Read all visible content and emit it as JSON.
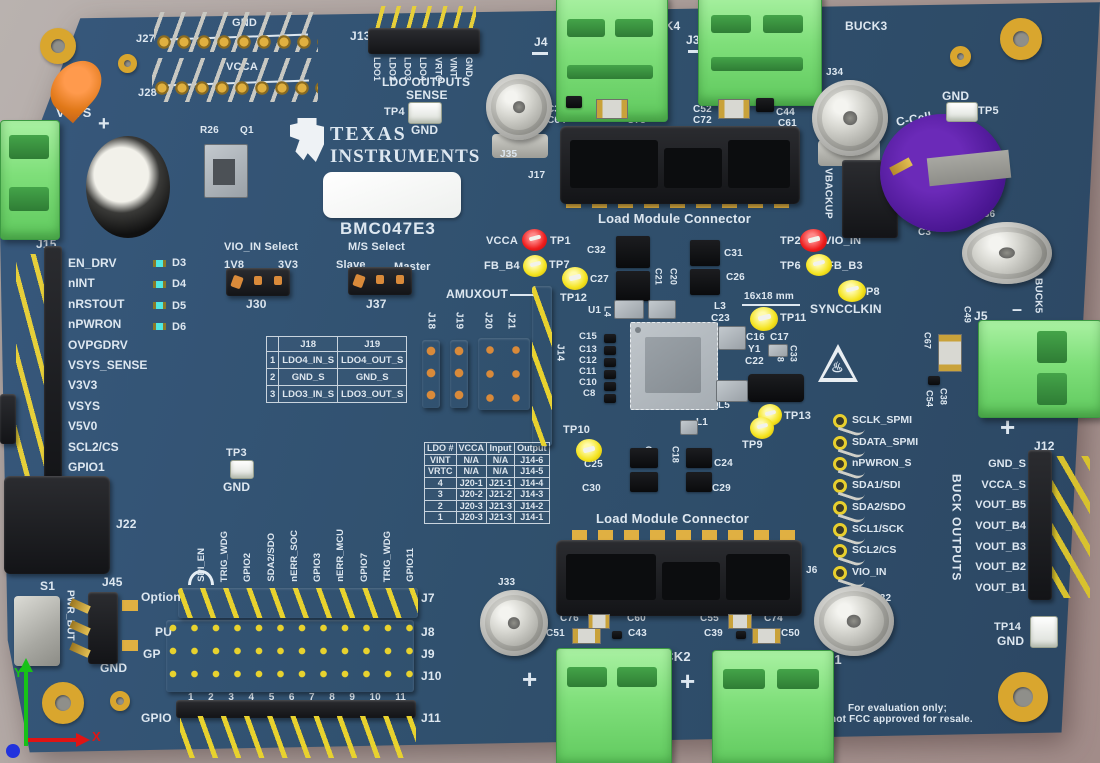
{
  "brand": {
    "line1": "TEXAS",
    "line2": "INSTRUMENTS",
    "logo_glyph": "ti",
    "part_number": "BMC047E3"
  },
  "eval_note": {
    "line1": "For evaluation only;",
    "line2": "not FCC approved for resale."
  },
  "icons": {
    "hot_surface": "♨",
    "plus": "+",
    "minus": "–",
    "axis_x": "X",
    "axis_y": "Y"
  },
  "refs": {
    "j27": "J27",
    "j28": "J28",
    "gnd_j27": "GND",
    "vcca_j28": "VCCA",
    "vsys_in": "VSYS",
    "r26": "R26",
    "q1": "Q1",
    "j13": "J13",
    "ldo_outputs": "LDO OUTPUTS",
    "sense": "SENSE",
    "tp4": "TP4",
    "gnd": "GND",
    "j4": "J4",
    "buck4": "BUCK4",
    "j3": "J3",
    "buck3": "BUCK3",
    "j35": "J35",
    "j17": "J17",
    "load_module": "Load Module Connector",
    "c37": "C37",
    "c64": "C64",
    "c53": "C53",
    "c73": "C73",
    "c52": "C52",
    "c72": "C72",
    "c44": "C44",
    "c61": "C61",
    "j34": "J34",
    "vbackup": "VBACKUP",
    "tp5": "TP5",
    "c_cell": "C-Cell",
    "c3": "C3",
    "j36": "J36",
    "buck5": "BUCK5",
    "j15": "J15",
    "j22": "J22",
    "vio_select": "VIO_IN Select",
    "vio_1v8": "1V8",
    "vio_3v3": "3V3",
    "ms_select": "M/S Select",
    "slave": "Slave",
    "master": "Master",
    "j30": "J30",
    "j37": "J37",
    "amuxout": "AMUXOUT",
    "j18": "J18",
    "j19": "J19",
    "j20": "J20",
    "j21": "J21",
    "j14": "J14",
    "vcca": "VCCA",
    "tp1": "TP1",
    "fb_b4": "FB_B4",
    "tp7": "TP7",
    "c27": "C27",
    "tp12": "TP12",
    "c32": "C32",
    "c21": "C21",
    "c20": "C20",
    "c31": "C31",
    "c26": "C26",
    "u1": "U1",
    "l1": "L1",
    "l3": "L3",
    "l4": "L4",
    "l5": "L5",
    "c23": "C23",
    "c15": "C15",
    "c13": "C13",
    "c12": "C12",
    "c11": "C11",
    "c10": "C10",
    "c8": "C8",
    "dim": "16x18 mm",
    "tp11": "TP11",
    "c16": "C16",
    "c17": "C17",
    "y1": "Y1",
    "c22": "C22",
    "c28": "C28",
    "c33": "C33",
    "tp2": "TP2",
    "vio_in": "VIO_IN",
    "tp6": "TP6",
    "fb_b3": "FB_B3",
    "p8": "P8",
    "syncclkin": "SYNCCLKIN",
    "tp3": "TP3",
    "tp10": "TP10",
    "tp9": "TP9",
    "tp13": "TP13",
    "c25": "C25",
    "c30": "C30",
    "c19": "C19",
    "c18": "C18",
    "c24": "C24",
    "c29": "C29",
    "j6": "J6",
    "j33": "J33",
    "j32": "J32",
    "c76": "C76",
    "c60": "C60",
    "c51": "C51",
    "c43": "C43",
    "c55": "C55",
    "c74": "C74",
    "c39": "C39",
    "c50": "C50",
    "buck2": "BUCK2",
    "buck1": "BUCK1",
    "s1": "S1",
    "pwr_but": "PWR_BUT",
    "j45": "J45",
    "option": "Option",
    "pu": "PU",
    "gp": "GP",
    "gpio": "GPIO",
    "j7": "J7",
    "j8": "J8",
    "j9": "J9",
    "j10": "J10",
    "j11": "J11",
    "j5": "J5",
    "j12": "J12",
    "buck_outputs": "BUCK OUTPUTS",
    "c49": "C49",
    "c67": "C67",
    "c38": "C38",
    "c54": "C54",
    "tp14": "TP14"
  },
  "lists": {
    "j15_labels": [
      "EN_DRV",
      "nINT",
      "nRSTOUT",
      "nPWRON",
      "OVPGDRV",
      "VSYS_SENSE",
      "V3V3",
      "VSYS",
      "V5V0",
      "SCL2/CS",
      "GPIO1"
    ],
    "led_labels": [
      "D3",
      "D4",
      "D5",
      "D6"
    ],
    "j13_pins": [
      "LDO1",
      "LDO2",
      "LDO3",
      "LDO4",
      "VRTC",
      "VINT",
      "GND_"
    ],
    "gpio_header_labels": [
      "SPI_EN",
      "TRIG_WDG",
      "GPIO2",
      "SDA2/SDO",
      "nERR_SOC",
      "GPIO3",
      "nERR_MCU",
      "GPIO7",
      "TRIG_WDG",
      "GPIO11"
    ],
    "pin_numbers": [
      "1",
      "2",
      "3",
      "4",
      "5",
      "6",
      "7",
      "8",
      "9",
      "10",
      "11"
    ],
    "spmi_testpoints": [
      "SCLK_SPMI",
      "SDATA_SPMI",
      "nPWRON_S",
      "SDA1/SDI",
      "SDA2/SDO",
      "SCL1/SCK",
      "SCL2/CS",
      "VIO_IN"
    ],
    "j12_labels": [
      "GND_S",
      "VCCA_S",
      "VOUT_B5",
      "VOUT_B4",
      "VOUT_B3",
      "VOUT_B2",
      "VOUT_B1"
    ]
  },
  "tables": {
    "ldo_sense_jumpers": {
      "headers": [
        "",
        "J18",
        "J19"
      ],
      "rows": [
        [
          "1",
          "LDO4_IN_S",
          "LDO4_OUT_S"
        ],
        [
          "2",
          "GND_S",
          "GND_S"
        ],
        [
          "3",
          "LDO3_IN_S",
          "LDO3_OUT_S"
        ]
      ]
    },
    "ldo_routing": {
      "headers": [
        "LDO #",
        "VCCA",
        "Input",
        "Output"
      ],
      "rows": [
        [
          "VINT",
          "N/A",
          "N/A",
          "J14-6"
        ],
        [
          "VRTC",
          "N/A",
          "N/A",
          "J14-5"
        ],
        [
          "4",
          "J20-1",
          "J21-1",
          "J14-4"
        ],
        [
          "3",
          "J20-2",
          "J21-2",
          "J14-3"
        ],
        [
          "2",
          "J20-3",
          "J21-3",
          "J14-2"
        ],
        [
          "1",
          "J20-3",
          "J21-3",
          "J14-1"
        ]
      ]
    }
  },
  "colors": {
    "board": "#30506d",
    "silkscreen": "#dde7f0",
    "terminal_green": "#7fdf7a",
    "gold": "#d9a62e",
    "tp_red": "#ee1c1c",
    "tp_yellow": "#f4e31d",
    "led_cyan": "#4fe8e2",
    "cap_purple": "#4a1692"
  }
}
